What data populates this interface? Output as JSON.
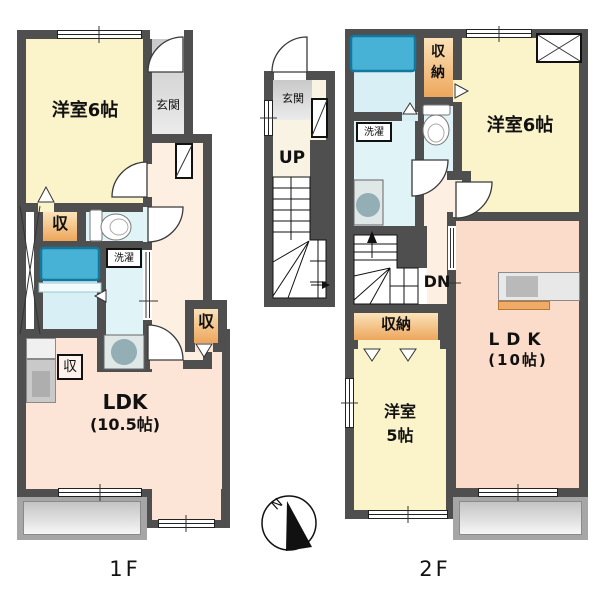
{
  "colors": {
    "wall": "#4f4f4f",
    "room_yellow": "#fbf4cb",
    "ldk_pink_1f": "#fce4d6",
    "ldk_pink_2f": "#fbdcca",
    "corridor_peach": "#fdf0e2",
    "water_cyan": "#e0f3f7",
    "bath_cyan": "#d8f0f5",
    "tub_blue": "#47b2d6",
    "closet_orange": "#eda65c",
    "entrance_gray": "#c9c9c9",
    "balcony_gray": "#a6a6a6"
  },
  "floor1": {
    "label": "1F",
    "yoshitsu6": "洋室6帖",
    "genkan": "玄関",
    "closet": "収",
    "closet_kitchen": "収",
    "closet_hall": "収",
    "laundry": "洗濯",
    "ldk": "LDK",
    "ldk_size": "(10.5帖)"
  },
  "stairwell": {
    "genkan": "玄関",
    "up": "UP"
  },
  "floor2": {
    "label": "2F",
    "closet_top": "収納",
    "laundry": "洗濯",
    "yoshitsu6": "洋室6帖",
    "dn": "DN",
    "closet_mid": "収納",
    "yoshitsu5": "洋室\n5帖",
    "ldk": "LDK",
    "ldk_size": "(10帖)"
  },
  "compass": {
    "north": "N"
  }
}
